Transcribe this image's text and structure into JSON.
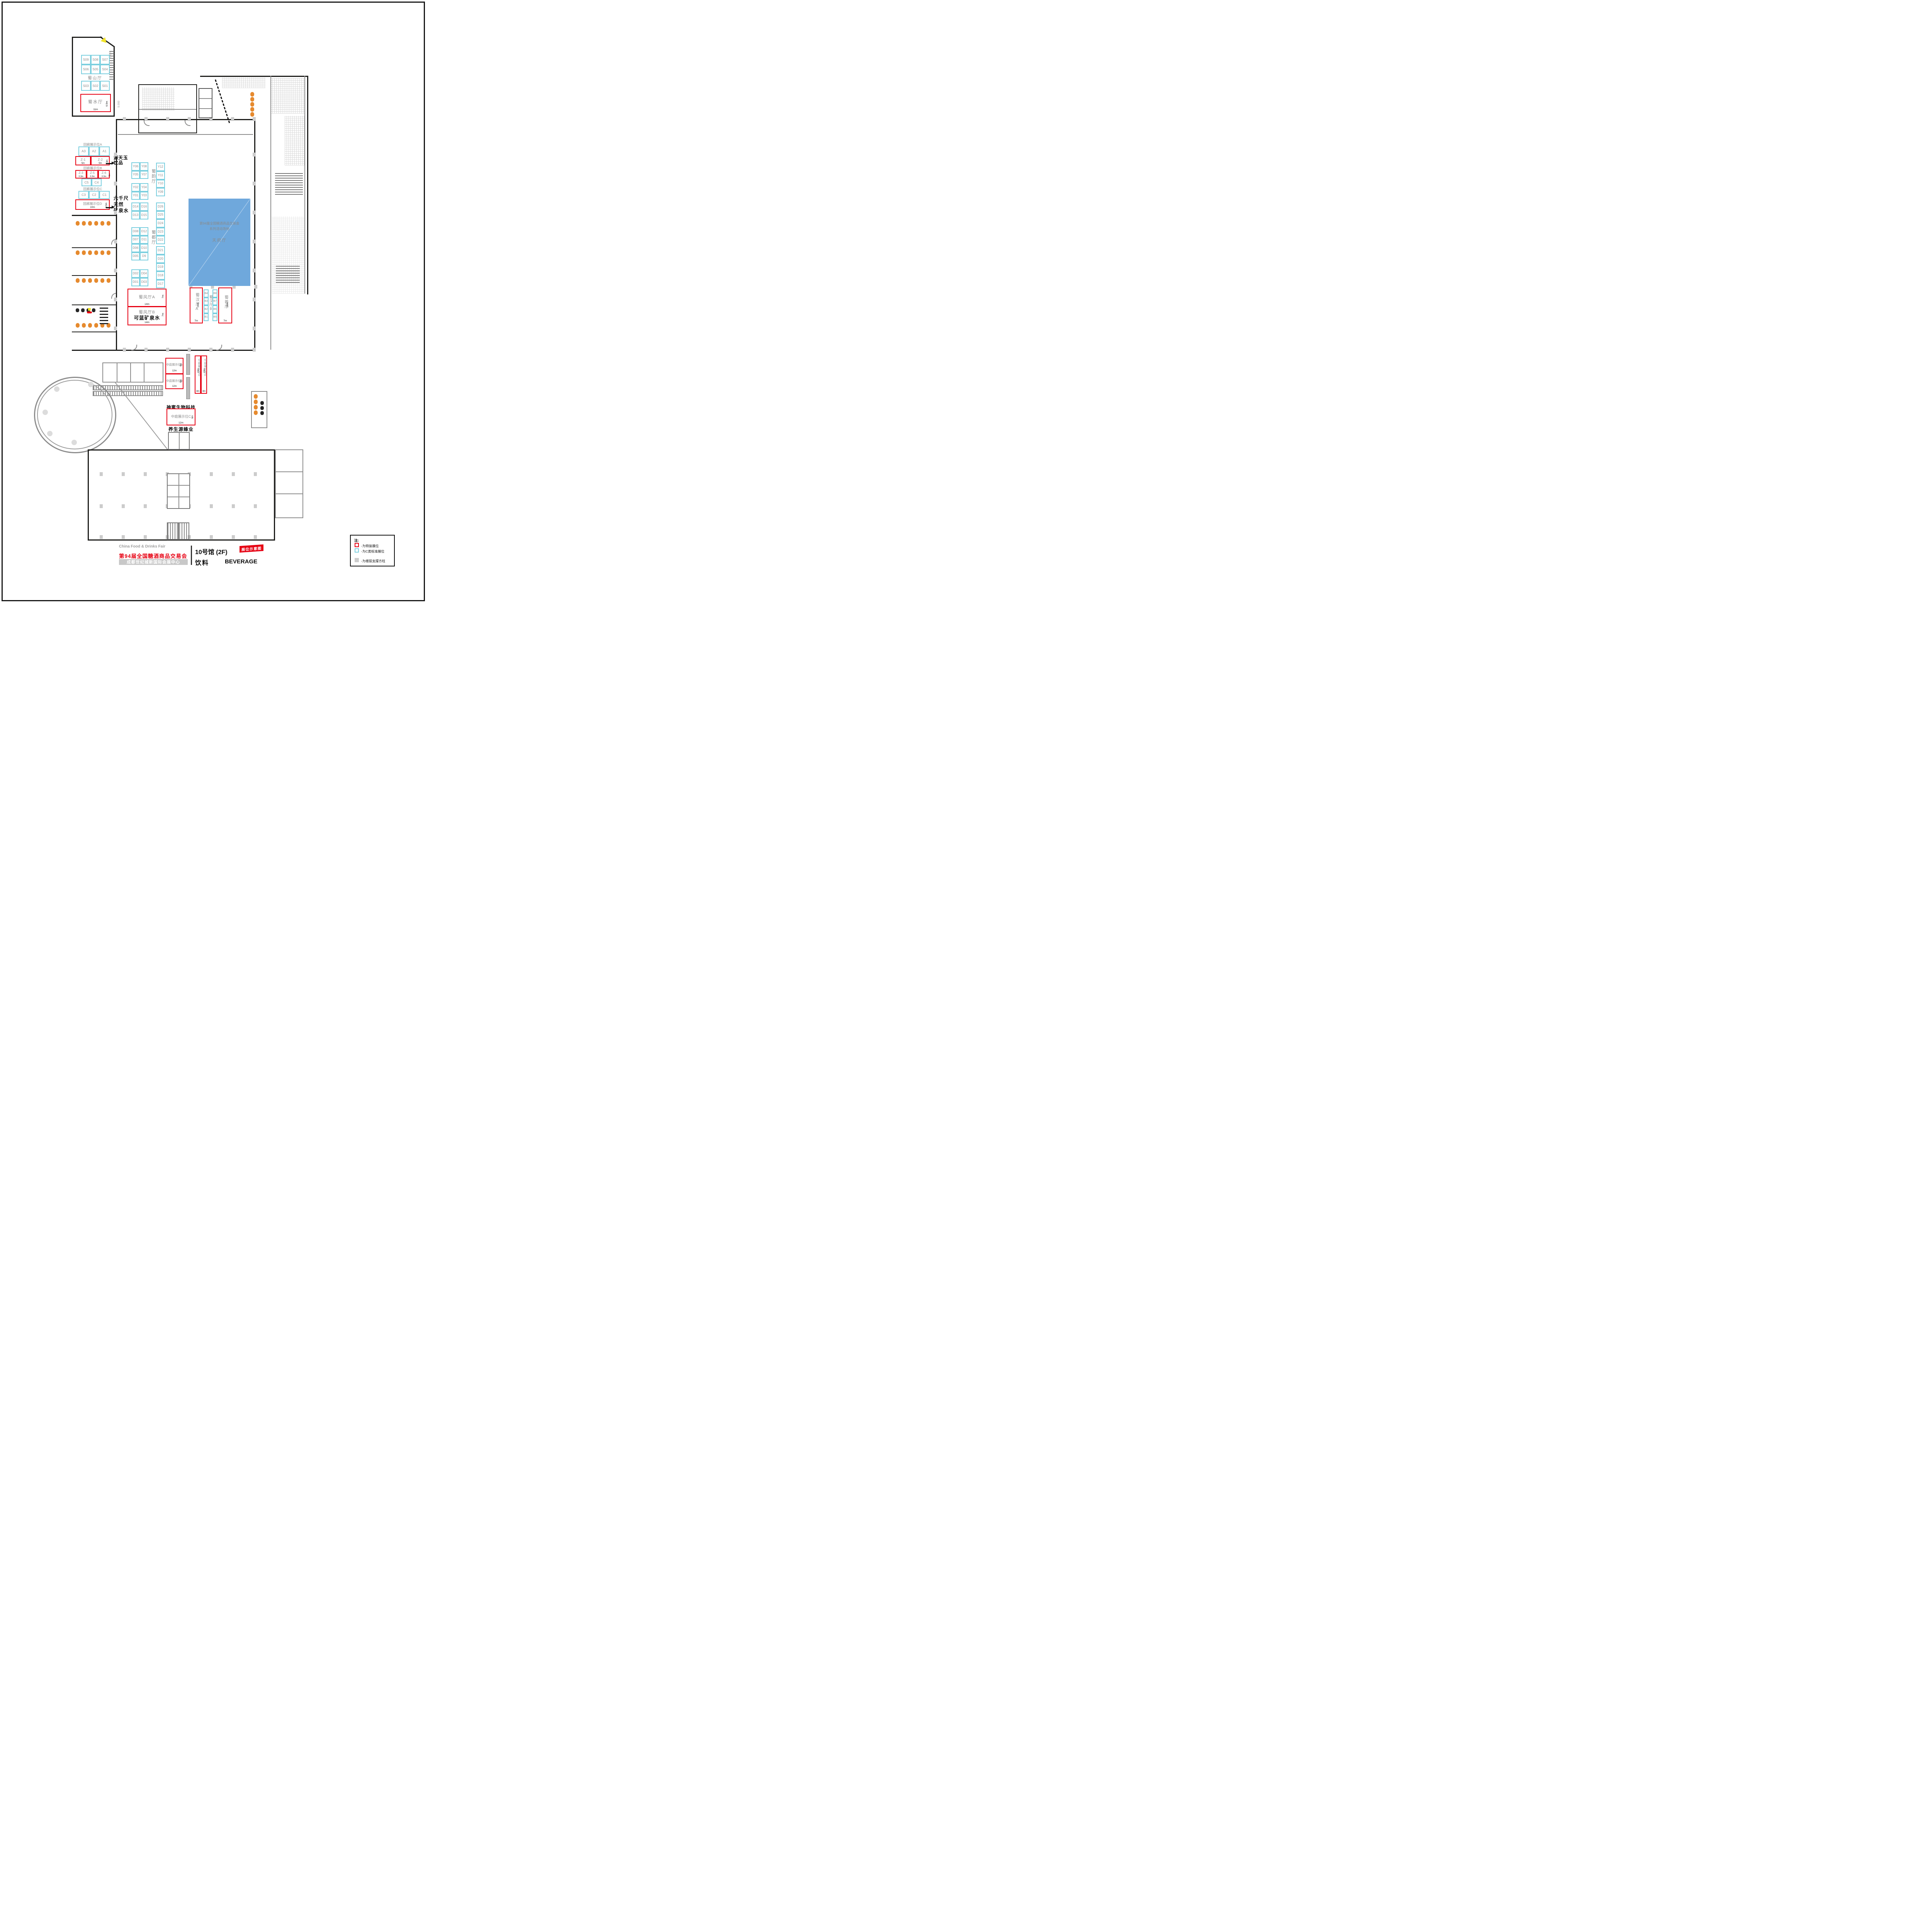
{
  "colors": {
    "special_red": "#e60012",
    "standard_cyan": "#7ccfdf",
    "pillar_gray": "#cccccc",
    "activity_blue": "#6fa8dc",
    "fixture_orange": "#e68a2e"
  },
  "rooms": {
    "shushan": {
      "name": "蜀山厅",
      "grid_top": [
        [
          "S09",
          "S08",
          "S07"
        ],
        [
          "S06",
          "S05",
          "S04"
        ]
      ],
      "grid_bottom": [
        [
          "S03",
          "S02",
          "S01"
        ]
      ]
    },
    "shushui": {
      "name": "蜀水厅",
      "width": "11m",
      "height": "6.5m"
    },
    "shuyun": {
      "name": "蜀韵厅",
      "grid_a": [
        [
          "Y06",
          "Y08"
        ],
        [
          "Y05",
          "Y07"
        ]
      ],
      "col": [
        "Y12",
        "Y11",
        "Y10",
        "Y09"
      ],
      "grid_b": [
        [
          "Y02",
          "Y04"
        ],
        [
          "Y01",
          "Y03"
        ]
      ]
    },
    "shudu": {
      "name": "蜀都厅",
      "grid_a": [
        [
          "D14",
          "D16"
        ],
        [
          "D13",
          "D15"
        ]
      ],
      "grid_b": [
        [
          "D08",
          "D12"
        ],
        [
          "D07",
          "D11"
        ],
        [
          "D06",
          "D10"
        ],
        [
          "D05",
          "D9"
        ]
      ],
      "grid_c": [
        [
          "D02",
          "D04"
        ],
        [
          "D01",
          "D03"
        ]
      ],
      "col_top": [
        "D26",
        "D25",
        "D24",
        "D23",
        "D22"
      ],
      "col_bottom": [
        "D21",
        "D20",
        "D19",
        "D18",
        "D17"
      ]
    },
    "tianfu": {
      "name": "天府厅",
      "line1": "第94届全国糖酒商品交易会",
      "line2": "系列活动场地"
    },
    "shufeng_a": {
      "name": "蜀风厅A",
      "width": "14m",
      "height": "7m"
    },
    "shufeng_b": {
      "name": "蜀风厅B",
      "brand": "可蓝矿泉水",
      "width": "14m",
      "height": "7m"
    },
    "shuhan_a": {
      "name": "蜀汉厅A",
      "width": "7m",
      "height": "14m"
    },
    "shuhan_b": {
      "name": "蜀汉厅B",
      "col_left": [
        "B4",
        "B3",
        "B2",
        "B1"
      ],
      "col_right": [
        "B8",
        "B7",
        "B6",
        "B5"
      ]
    },
    "shurong": {
      "name": "蜀蓉厅",
      "width": "7m",
      "height": "14m"
    }
  },
  "corridor": {
    "a": {
      "label": "回廊展示位A",
      "cyan": [
        "A3",
        "A2",
        "A1"
      ],
      "z1": {
        "id": "Z-1",
        "w": "5m"
      },
      "z2": {
        "id": "Z-2",
        "w": "5m",
        "h": "3m"
      },
      "callout": [
        "源天玉",
        "饮品"
      ]
    },
    "b": {
      "label": "回廊展示位B",
      "z3": {
        "id": "Z-3",
        "w": "3.3m"
      },
      "z5": {
        "id": "Z-5",
        "w": "3.3m"
      },
      "z6": {
        "id": "Z-6",
        "w": "3.3m",
        "h": "3m"
      },
      "cyan": [
        "C5",
        "C4"
      ]
    },
    "c": {
      "label": "回廊展示位C",
      "cyan": [
        "C3",
        "C2",
        "C1"
      ]
    },
    "d": {
      "label": "回廊展示位D",
      "w": "10m",
      "h": "3.5m",
      "callout": [
        "六千尺",
        "天然",
        "矿泉水"
      ]
    }
  },
  "atrium": {
    "a": {
      "label": "中庭展示位A",
      "w": "12m",
      "h": "6m"
    },
    "b": {
      "label": "中庭展示位B",
      "w": "12m",
      "h": "6m"
    },
    "c": {
      "label": "中庭展示位C",
      "w": "12m",
      "h": "6m",
      "brand_top": "神蜜生物科技",
      "brand_bottom": "养生源蜂业"
    },
    "d": {
      "label": "中庭展示位D",
      "w": "4m",
      "h": "15m"
    },
    "e": {
      "label": "中庭展示位E",
      "w": "4m",
      "h": "15m"
    }
  },
  "markers": {
    "elev_a": "8.000",
    "elev_b": "9.000"
  },
  "legend": {
    "note": "注:",
    "special": "-为特装展位",
    "standard": "-为C类标准展位",
    "pillar": "-为楼层支撑方柱"
  },
  "footer": {
    "fair_en": "China Food & Drinks Fair",
    "fair_cn": "第94届全国糖酒商品交易会",
    "venue": "成都世纪城新国际会展中心",
    "hall": "10号馆 (2F)",
    "category_cn": "饮料",
    "category_en": "BEVERAGE",
    "badge": "展位示意图"
  }
}
